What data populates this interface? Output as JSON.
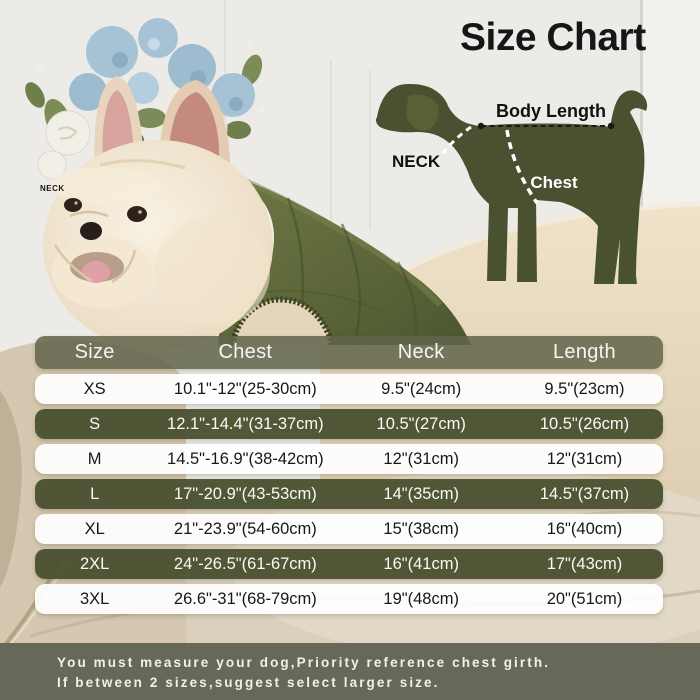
{
  "title": "Size Chart",
  "diagram": {
    "body_length_label": "Body Length",
    "neck_label": "NECK",
    "chest_label": "Chest"
  },
  "photo": {
    "neck_tag": "NECK"
  },
  "size_table": {
    "columns": [
      "Size",
      "Chest",
      "Neck",
      "Length"
    ],
    "rows": [
      {
        "size": "XS",
        "chest": "10.1\"-12\"(25-30cm)",
        "neck": "9.5\"(24cm)",
        "length": "9.5\"(23cm)",
        "variant": "light"
      },
      {
        "size": "S",
        "chest": "12.1\"-14.4\"(31-37cm)",
        "neck": "10.5\"(27cm)",
        "length": "10.5\"(26cm)",
        "variant": "dark"
      },
      {
        "size": "M",
        "chest": "14.5\"-16.9\"(38-42cm)",
        "neck": "12\"(31cm)",
        "length": "12\"(31cm)",
        "variant": "light"
      },
      {
        "size": "L",
        "chest": "17\"-20.9\"(43-53cm)",
        "neck": "14\"(35cm)",
        "length": "14.5\"(37cm)",
        "variant": "dark"
      },
      {
        "size": "XL",
        "chest": "21\"-23.9\"(54-60cm)",
        "neck": "15\"(38cm)",
        "length": "16\"(40cm)",
        "variant": "light"
      },
      {
        "size": "2XL",
        "chest": "24\"-26.5\"(61-67cm)",
        "neck": "16\"(41cm)",
        "length": "17\"(43cm)",
        "variant": "dark"
      },
      {
        "size": "3XL",
        "chest": "26.6\"-31\"(68-79cm)",
        "neck": "19\"(48cm)",
        "length": "20\"(51cm)",
        "variant": "light"
      }
    ]
  },
  "note": {
    "line1": "You must measure your dog,Priority reference chest girth.",
    "line2": "If between 2 sizes,suggest select larger size."
  },
  "chart_data": {
    "type": "table",
    "title": "Size Chart",
    "columns": [
      "Size",
      "Chest",
      "Neck",
      "Length"
    ],
    "rows": [
      [
        "XS",
        "10.1\"-12\"(25-30cm)",
        "9.5\"(24cm)",
        "9.5\"(23cm)"
      ],
      [
        "S",
        "12.1\"-14.4\"(31-37cm)",
        "10.5\"(27cm)",
        "10.5\"(26cm)"
      ],
      [
        "M",
        "14.5\"-16.9\"(38-42cm)",
        "12\"(31cm)",
        "12\"(31cm)"
      ],
      [
        "L",
        "17\"-20.9\"(43-53cm)",
        "14\"(35cm)",
        "14.5\"(37cm)"
      ],
      [
        "XL",
        "21\"-23.9\"(54-60cm)",
        "15\"(38cm)",
        "16\"(40cm)"
      ],
      [
        "2XL",
        "24\"-26.5\"(61-67cm)",
        "16\"(41cm)",
        "17\"(43cm)"
      ],
      [
        "3XL",
        "26.6\"-31\"(68-79cm)",
        "19\"(48cm)",
        "20\"(51cm)"
      ]
    ]
  },
  "colors": {
    "row_olive": "#49502e",
    "header_olive": "#61644a",
    "note_band": "#67685a",
    "silhouette": "#4a5130",
    "vest": "#5c6637",
    "couch": "#ddd0ba",
    "wall": "#ecebe7"
  }
}
